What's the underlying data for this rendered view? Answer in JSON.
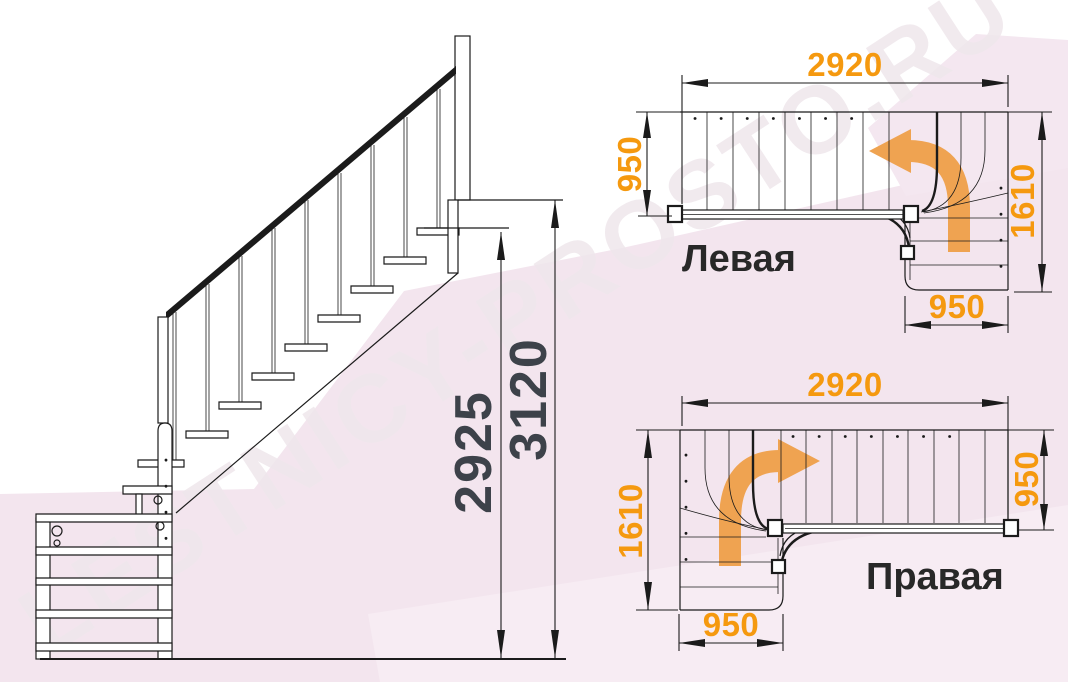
{
  "watermark": "LESTNICY-PROSTO.RU",
  "side_view": {
    "dim_flight_height": "2925",
    "dim_total_height": "3120"
  },
  "plan_left": {
    "label": "Левая",
    "dim_top": "2920",
    "dim_left": "950",
    "dim_right": "1610",
    "dim_bottom": "950"
  },
  "plan_right": {
    "label": "Правая",
    "dim_top": "2920",
    "dim_left": "1610",
    "dim_right": "950",
    "dim_bottom": "950"
  },
  "colors": {
    "orange": "#f5990f",
    "arrow": "#efa351",
    "ink": "#1b1b1b",
    "dim": "#3d424a",
    "label": "#282828",
    "wm": "#efe7ec",
    "pink1": "#f3e5ee",
    "pink2": "#f7ecf3",
    "pink3": "#f4e7f0"
  }
}
